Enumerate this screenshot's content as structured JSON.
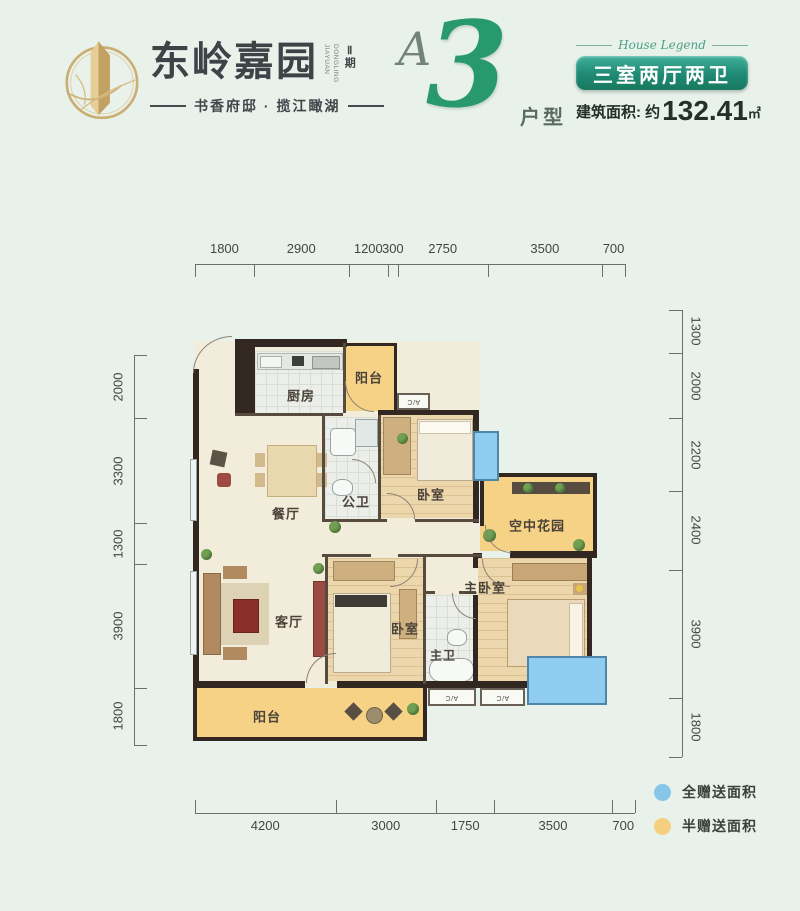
{
  "header": {
    "logo": {
      "brand": "东岭嘉园",
      "brand_latin": "DONGLING JIAYUAN",
      "phase": "Ⅱ期",
      "tagline": "书香府邸 · 揽江瞰湖"
    },
    "unit": {
      "letter": "A",
      "number": "3",
      "suffix": "户型"
    },
    "info": {
      "script_caption": "House Legend",
      "badge": "三室两厅两卫",
      "area_label": "建筑面积: 约",
      "area_value": "132.41",
      "area_unit": "㎡"
    }
  },
  "dimensions": {
    "top": [
      1800,
      2900,
      1200,
      300,
      2750,
      3500,
      700
    ],
    "bottom": [
      4200,
      3000,
      1750,
      3500,
      700
    ],
    "left": [
      2000,
      3300,
      1300,
      3900,
      1800
    ],
    "right": [
      1300,
      2000,
      2200,
      2400,
      3900,
      1800
    ]
  },
  "rooms": {
    "kitchen": "厨房",
    "balcony_top": "阳台",
    "guest_bath": "公卫",
    "bedroom_top": "卧室",
    "dining": "餐厅",
    "sky_garden": "空中花园",
    "living": "客厅",
    "bedroom_mid": "卧室",
    "master_bedroom": "主卧室",
    "master_bath": "主卫",
    "balcony_bottom": "阳台",
    "ac_unit": "A/C"
  },
  "legend": [
    {
      "label": "全赠送面积",
      "color": "#85c6e9"
    },
    {
      "label": "半赠送面积",
      "color": "#f6cf7e"
    }
  ],
  "colors": {
    "background": "#e8f1ea",
    "badge_teal": "#1f8974",
    "number_green": "#27996d",
    "logo_gold": "#c9aa6e",
    "gift_full_blue": "#85c6e9",
    "gift_half_yellow": "#f6cf7e",
    "wall_dark": "#322821"
  }
}
